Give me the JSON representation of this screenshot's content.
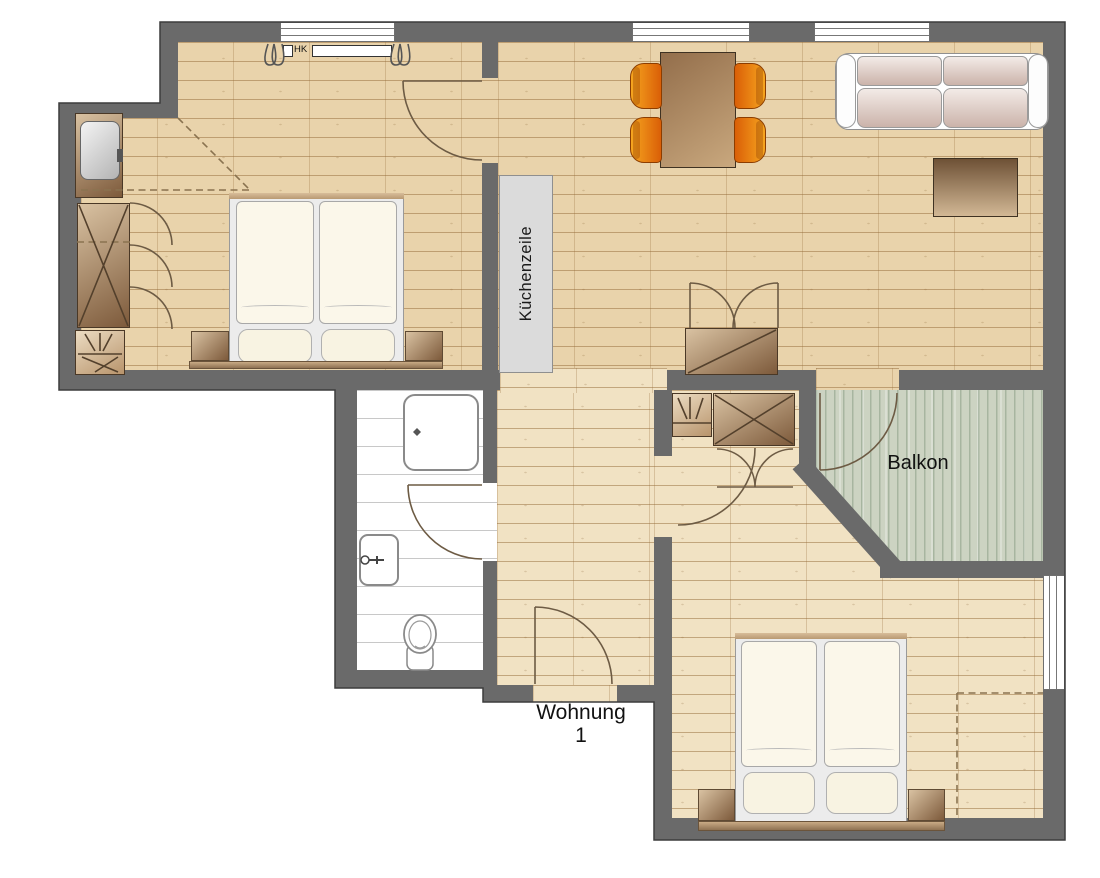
{
  "plan": {
    "labels": {
      "kitchen_unit": "Küchenzeile",
      "balcony": "Balkon",
      "apartment_name": "Wohnung",
      "apartment_number": "1",
      "radiator_abbrev": "HK"
    },
    "colors": {
      "wall": "#6a6a6a",
      "wall_outline": "#3c3c3c",
      "wood_floor": "#e9d3ab",
      "wood_floor_light": "#f1e2c3",
      "wood_line": "rgba(148,106,56,0.50)",
      "wood_line_soft": "rgba(148,106,56,0.28)",
      "balcony_floor": "#ccd3c2",
      "balcony_line": "rgba(122,144,118,0.45)",
      "bathroom_tile_line": "#c8c8c8",
      "kitchen_unit_fill": "#dbdbdb",
      "furniture_dark": "#7d5a3b",
      "furniture_light": "#d9c2a2",
      "chair_orange": "#f6a51f",
      "chair_orange_dark": "#da5f07",
      "linen": "#fbf7ea",
      "door_arc": "#6d5b44",
      "dashed": "#8a7350",
      "fixture_stroke": "#8a8a8a"
    }
  }
}
